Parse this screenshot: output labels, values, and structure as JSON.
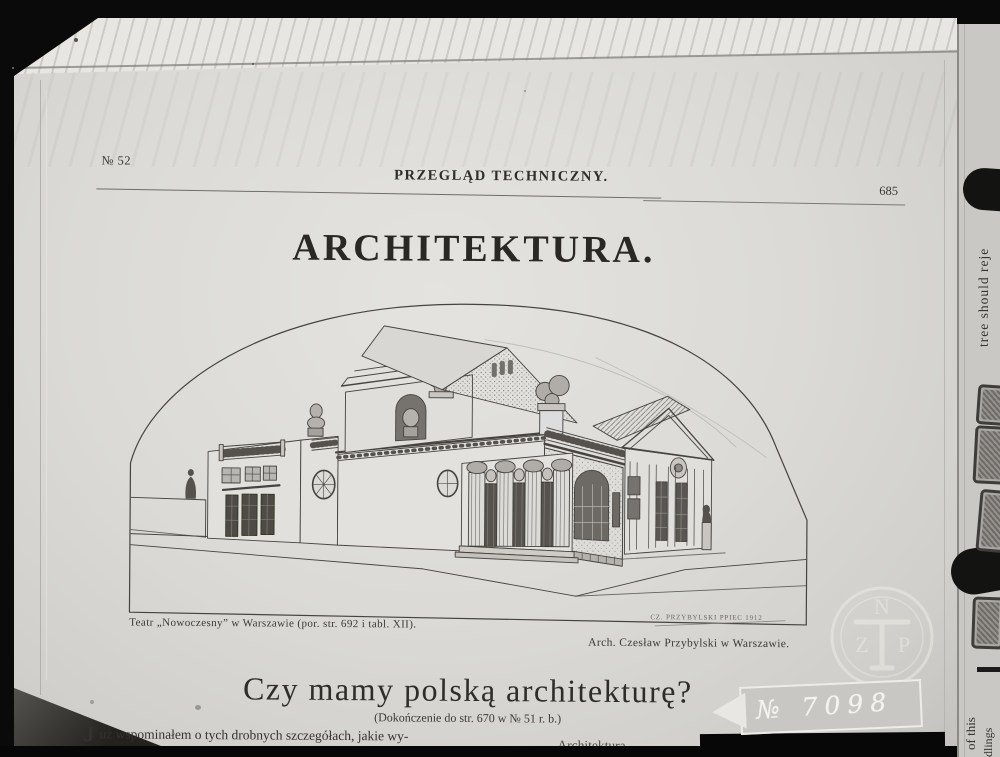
{
  "header": {
    "issue": "№ 52",
    "journal": "PRZEGLĄD TECHNICZNY.",
    "page": "685"
  },
  "article": {
    "section_title": "ARCHITEKTURA.",
    "heading": "Czy mamy polską architekturę?",
    "subheading": "(Dokończenie do str. 670 w № 51 r. b.)",
    "body_left_dropcap": "J",
    "body_left": "uż wspominałem o tych drobnych szczegółach, jakie wy-",
    "body_right": "Architektura"
  },
  "figure": {
    "caption_left": "Teatr „Nowoczesny” w Warszawie (por. str. 692 i tabl. XII).",
    "caption_right": "Arch. Czesław Przybylski w Warszawie.",
    "signature": "CZ. PRZYBYLSKI  PPIEC 1912"
  },
  "artifacts": {
    "archive_label": "№ 7098",
    "edge_text_upper": "tree should reje",
    "edge_text_lower_1": "of this",
    "edge_text_lower_2": "dlings",
    "watermark": {
      "top": "N",
      "left": "Z",
      "right": "P"
    }
  },
  "colors": {
    "paper": "#dbdad6",
    "film_black": "#0a0a0a",
    "ink": "#2b2a27",
    "label_ink": "#f4f3ef"
  }
}
